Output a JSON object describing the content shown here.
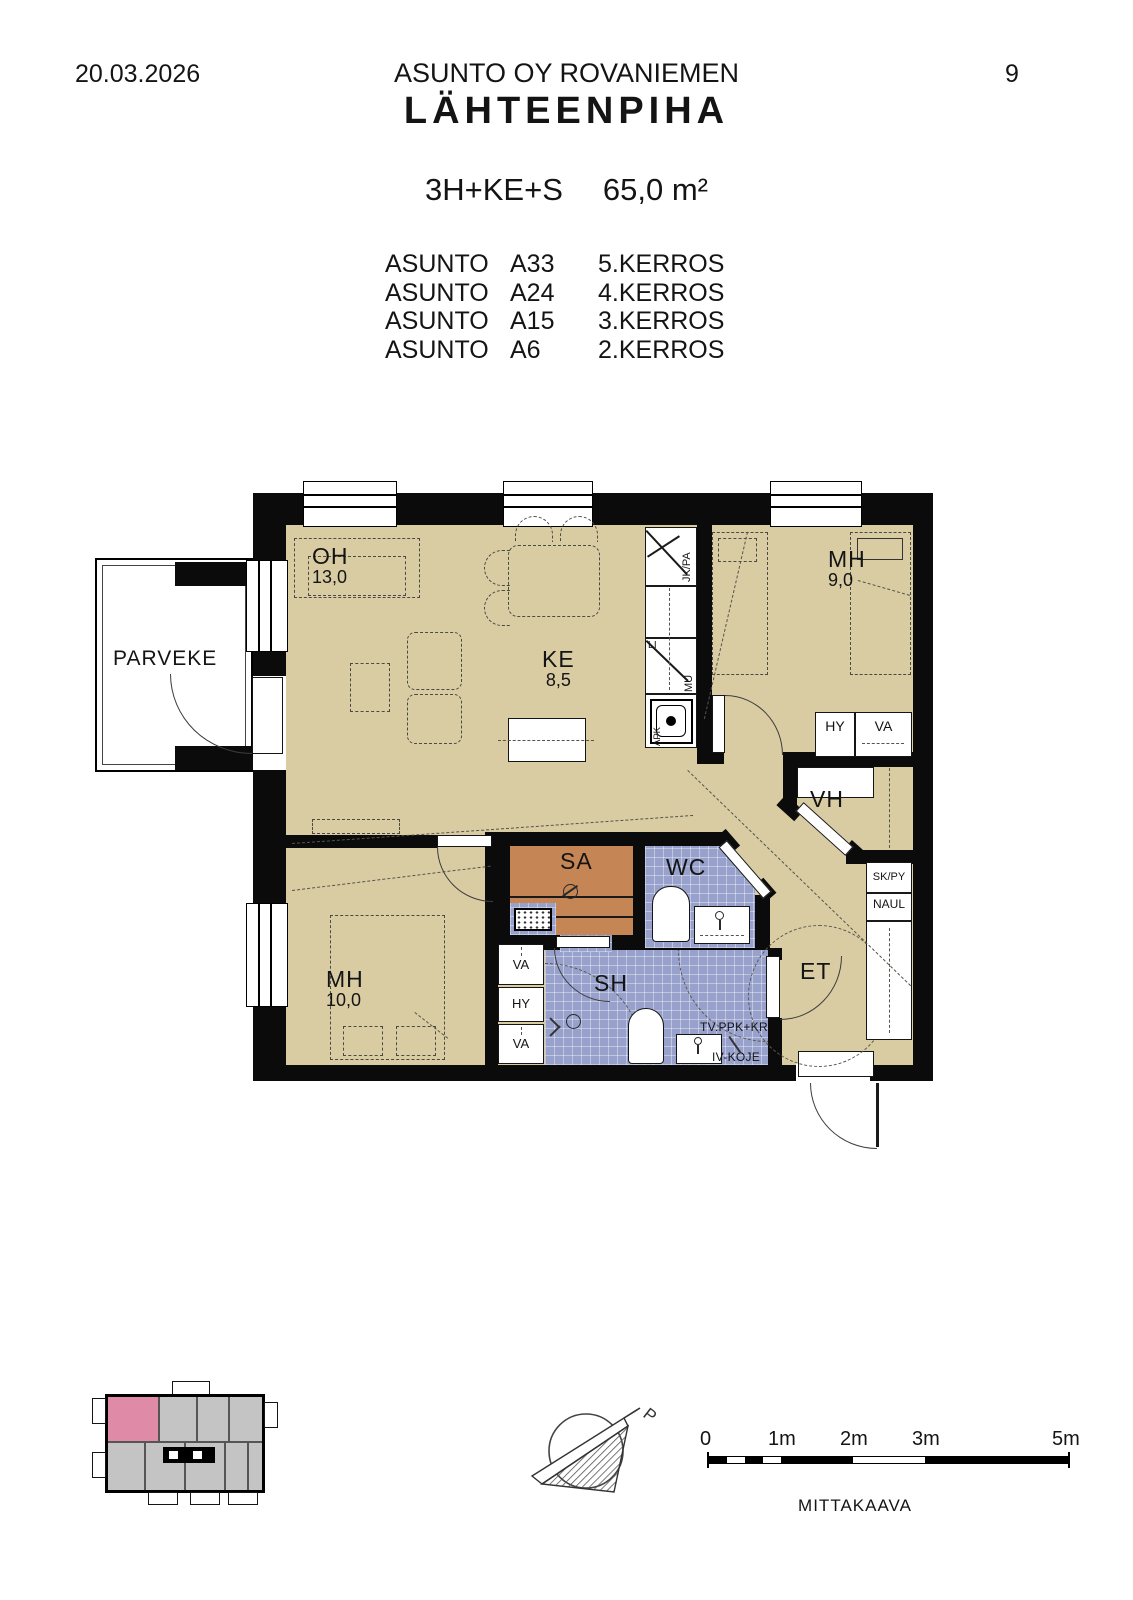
{
  "header": {
    "date": "20.03.2026",
    "company": "ASUNTO OY ROVANIEMEN",
    "project": "LÄHTEENPIHA",
    "page": "9"
  },
  "apartment": {
    "type": "3H+KE+S",
    "area": "65,0 m²",
    "unit_label": "ASUNTO",
    "units": [
      {
        "id": "A33",
        "floor": "5.KERROS"
      },
      {
        "id": "A24",
        "floor": "4.KERROS"
      },
      {
        "id": "A15",
        "floor": "3.KERROS"
      },
      {
        "id": "A6",
        "floor": "2.KERROS"
      }
    ]
  },
  "plan": {
    "rooms": {
      "parveke": {
        "name": "PARVEKE"
      },
      "oh": {
        "name": "OH",
        "area": "13,0"
      },
      "ke": {
        "name": "KE",
        "area": "8,5"
      },
      "mh1": {
        "name": "MH",
        "area": "9,0"
      },
      "mh2": {
        "name": "MH",
        "area": "10,0"
      },
      "vh": {
        "name": "VH"
      },
      "wc": {
        "name": "WC"
      },
      "sa": {
        "name": "SA"
      },
      "sh": {
        "name": "SH"
      },
      "et": {
        "name": "ET"
      }
    },
    "fixtures": {
      "fridge": "JK/PA",
      "stove": "LI",
      "micro": "MU",
      "dishwasher": "APK",
      "hy": "HY",
      "va": "VA",
      "sk_py": "SK/PY",
      "naul": "NAUL",
      "laundry": "TV.PPK+KR",
      "vent": "IV-KOJE"
    }
  },
  "footer": {
    "compass_n": "P",
    "scale_ticks": [
      "0",
      "1m",
      "2m",
      "3m",
      "5m"
    ],
    "scale_caption": "MITTAKAAVA"
  },
  "colors": {
    "wall": "#0b0b0b",
    "floor_tan": "#d9cca3",
    "wet_blue": "#97a1cc",
    "sauna_wood": "#c58554",
    "keyplan_gray": "#c4c4c4",
    "keyplan_pink": "#df8aa6"
  }
}
